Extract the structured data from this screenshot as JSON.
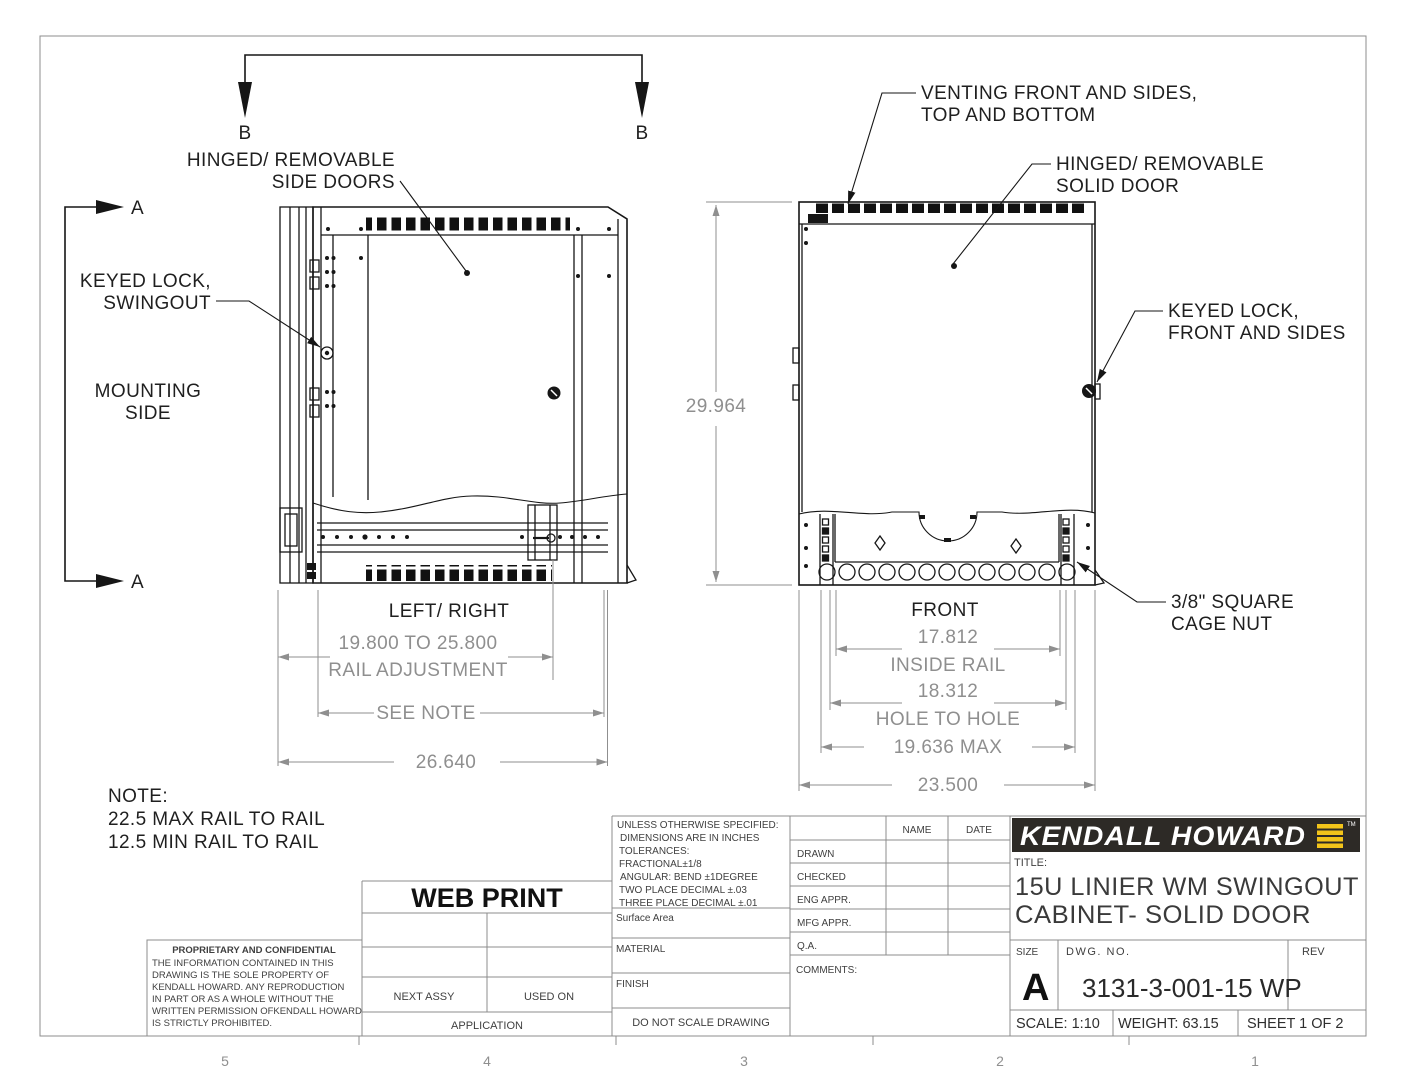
{
  "page": {
    "zone_labels": [
      "5",
      "4",
      "3",
      "2",
      "1"
    ]
  },
  "sections": {
    "a_label": "A",
    "b_label": "B"
  },
  "callouts": {
    "hinged_side_doors": {
      "line1": "HINGED/ REMOVABLE",
      "line2": "SIDE DOORS"
    },
    "keyed_lock_swingout": {
      "line1": "KEYED LOCK,",
      "line2": "SWINGOUT"
    },
    "mounting_side": {
      "line1": "MOUNTING",
      "line2": "SIDE"
    },
    "venting": {
      "line1": "VENTING FRONT AND SIDES,",
      "line2": "TOP AND BOTTOM"
    },
    "hinged_solid_door": {
      "line1": "HINGED/ REMOVABLE",
      "line2": "SOLID DOOR"
    },
    "keyed_lock_front": {
      "line1": "KEYED LOCK,",
      "line2": "FRONT AND SIDES"
    },
    "cage_nut": {
      "line1": "3/8\" SQUARE",
      "line2": "CAGE NUT"
    }
  },
  "views": {
    "side_label": "LEFT/ RIGHT",
    "front_label": "FRONT"
  },
  "dimensions": {
    "height": "29.964",
    "rail_adjustment": {
      "value": "19.800 TO 25.800",
      "label": "RAIL ADJUSTMENT"
    },
    "see_note": "SEE NOTE",
    "depth": "26.640",
    "inside_rail": {
      "value": "17.812",
      "label": "INSIDE RAIL"
    },
    "hole_to_hole": {
      "value": "18.312",
      "label": "HOLE TO HOLE"
    },
    "max_rail": "19.636 MAX",
    "overall_width": "23.500"
  },
  "note": {
    "heading": "NOTE:",
    "line1": "22.5 MAX RAIL TO RAIL",
    "line2": "12.5 MIN RAIL TO RAIL"
  },
  "title_block": {
    "stamp": "WEB PRINT",
    "spec": {
      "line1": "UNLESS OTHERWISE SPECIFIED:",
      "line2": "DIMENSIONS ARE IN INCHES",
      "line3": "TOLERANCES:",
      "line4": "FRACTIONAL±1/8",
      "line5": "ANGULAR: BEND ±1DEGREE",
      "line6": "TWO PLACE DECIMAL  ±.03",
      "line7": "THREE PLACE DECIMAL ±.01"
    },
    "surface_area": "Surface Area",
    "material": "MATERIAL",
    "finish": "FINISH",
    "do_not_scale": "DO NOT SCALE DRAWING",
    "next_assy": "NEXT ASSY",
    "used_on": "USED ON",
    "application": "APPLICATION",
    "proprietary": {
      "heading": "PROPRIETARY AND CONFIDENTIAL",
      "lines": [
        "THE INFORMATION CONTAINED IN THIS",
        "DRAWING IS THE SOLE PROPERTY OF",
        "KENDALL HOWARD.  ANY REPRODUCTION",
        "IN PART OR AS A WHOLE WITHOUT THE",
        "WRITTEN PERMISSION OFKENDALL HOWARD",
        "IS STRICTLY PROHIBITED."
      ]
    },
    "approvals": {
      "name": "NAME",
      "date": "DATE",
      "drawn": "DRAWN",
      "checked": "CHECKED",
      "eng": "ENG APPR.",
      "mfg": "MFG APPR.",
      "qa": "Q.A.",
      "comments": "COMMENTS:"
    },
    "brand": {
      "name": "KENDALL HOWARD",
      "tm": "TM"
    },
    "title_label": "TITLE:",
    "title1": "15U LINIER WM SWINGOUT",
    "title2": "CABINET- SOLID DOOR",
    "size_label": "SIZE",
    "size": "A",
    "dwg_label": "DWG.  NO.",
    "dwg_no": "3131-3-001-15 WP",
    "rev_label": "REV",
    "scale": "SCALE: 1:10",
    "weight": "WEIGHT: 63.15",
    "sheet": "SHEET 1 OF 2"
  },
  "colors": {
    "line": "#161616",
    "dim": "#8f8f8f",
    "brand_bar": "#2d2a26",
    "brand_yellow": "#f2c41a"
  }
}
